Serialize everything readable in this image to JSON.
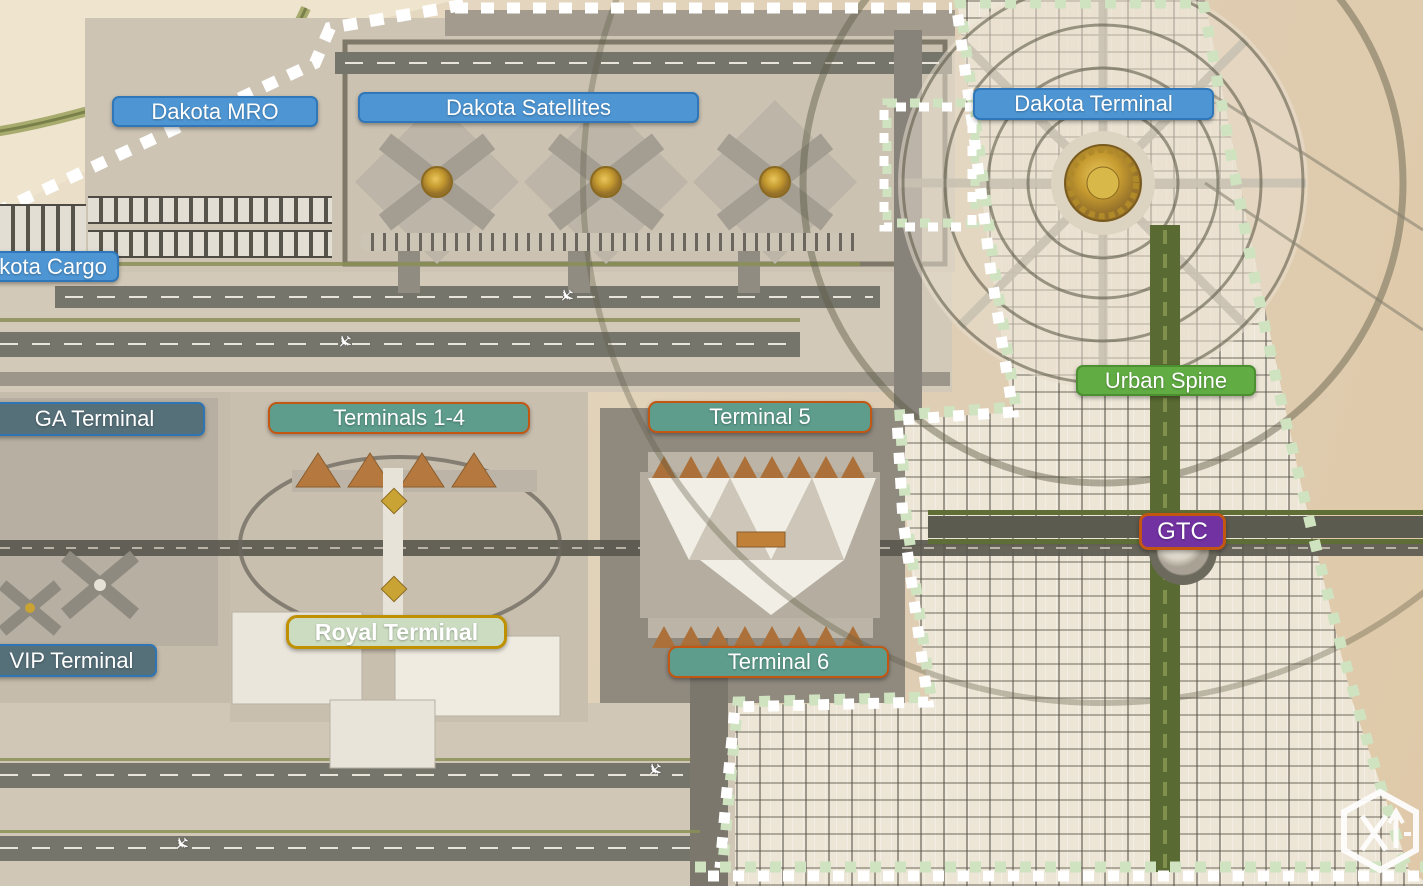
{
  "labels": {
    "dakota_mro": {
      "text": "Dakota MRO"
    },
    "dakota_satellites": {
      "text": "Dakota Satellites"
    },
    "dakota_terminal": {
      "text": "Dakota Terminal"
    },
    "dakota_cargo": {
      "text": "Dakota Cargo"
    },
    "ga_terminal": {
      "text": "GA Terminal"
    },
    "vip_terminal": {
      "text": "VIP Terminal"
    },
    "terminals_1_4": {
      "text": "Terminals 1-4"
    },
    "terminal_5": {
      "text": "Terminal 5"
    },
    "terminal_6": {
      "text": "Terminal 6"
    },
    "royal_terminal": {
      "text": "Royal Terminal"
    },
    "urban_spine": {
      "text": "Urban Spine"
    },
    "gtc": {
      "text": "GTC"
    }
  },
  "colors": {
    "label_blue": "#4E96D3",
    "label_blue_border": "#2F77B8",
    "label_slate": "#56707A",
    "label_slate_border": "#2E75B6",
    "label_teal": "#5E9C8C",
    "label_orange_border": "#C35712",
    "label_green": "#61AC43",
    "label_green_border": "#4C8F31",
    "label_purple": "#7232A2",
    "label_sage": "#CBDCC1",
    "label_gold_border": "#BF9000",
    "boundary_white": "#FFFFFF",
    "boundary_green": "#CFE3C0"
  },
  "watermark": {
    "icon": "hexagon-x-arrow-logo"
  }
}
